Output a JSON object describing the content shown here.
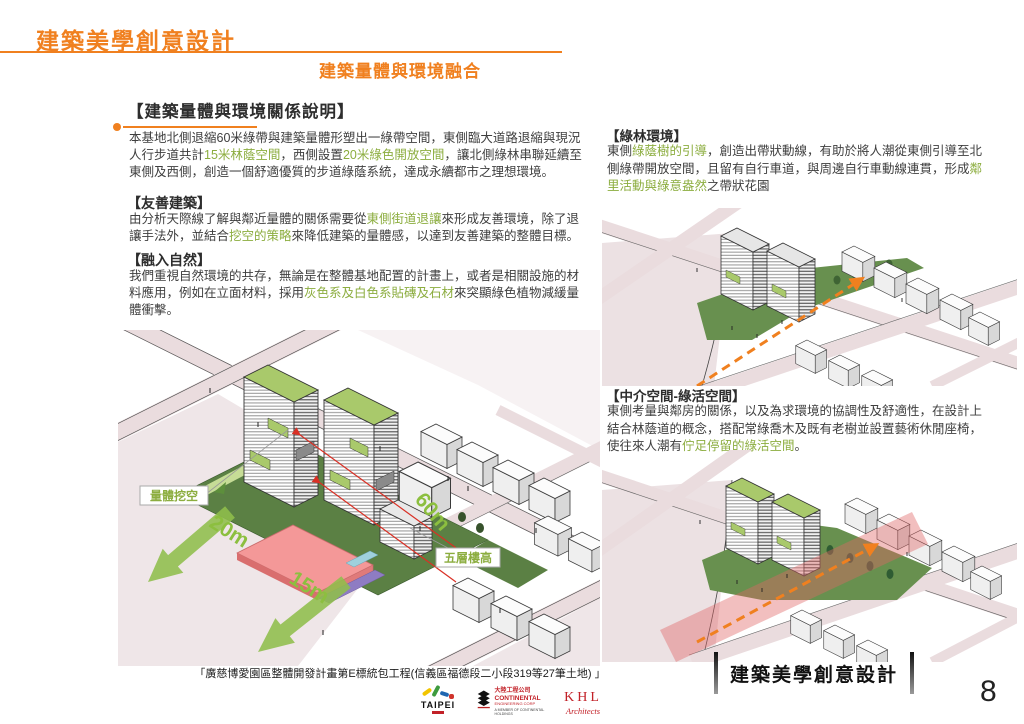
{
  "colors": {
    "accent_orange": "#f0801f",
    "highlight_green": "#8cad3f",
    "lawn_green": "#5b8044",
    "roof_green": "#a9c96b",
    "arrow_green": "#8fbe4b",
    "plaza_red": "#f49898",
    "street_pink": "#eadcde",
    "logo_red": "#c22128"
  },
  "header": {
    "title": "建築美學創意設計",
    "subtitle": "建築量體與環境融合"
  },
  "left_column": {
    "main_heading": "【建築量體與環境關係說明】",
    "intro_segments": [
      {
        "t": "本基地北側退縮60米綠帶與建築量體形塑出一綠帶空間，東側臨大道路退縮與現況人行步道共計"
      },
      {
        "t": "15米林蔭空間",
        "g": true
      },
      {
        "t": "，西側設置"
      },
      {
        "t": "20米綠色開放空間",
        "g": true
      },
      {
        "t": "，讓北側綠林串聯延續至東側及西側，創造一個舒適優質的步道綠蔭系統，達成永續都市之理想環境。"
      }
    ],
    "friendly_heading": "【友善建築】",
    "friendly_segments": [
      {
        "t": "由分析天際線了解與鄰近量體的關係需要從"
      },
      {
        "t": "東側街道退讓",
        "g": true
      },
      {
        "t": "來形成友善環境，除了退讓手法外，並結合"
      },
      {
        "t": "挖空的策略",
        "g": true
      },
      {
        "t": "來降低建築的量體感，以達到友善建築的整體目標。"
      }
    ],
    "nature_heading": "【融入自然】",
    "nature_segments": [
      {
        "t": "我們重視自然環境的共存，無論是在整體基地配置的計畫上，或者是相關設施的材料應用，例如在立面材料，採用"
      },
      {
        "t": "灰色系及白色系貼磚及石材",
        "g": true
      },
      {
        "t": "來突顯綠色植物減緩量體衝擊。"
      }
    ]
  },
  "right_column": {
    "green_env_heading": "【綠林環境】",
    "green_env_segments": [
      {
        "t": "東側"
      },
      {
        "t": "綠蔭樹的引導",
        "g": true
      },
      {
        "t": "，創造出帶狀動線，有助於將人潮從東側引導至北側綠帶開放空間，且留有自行車道，與周邊自行車動線連貫，形成"
      },
      {
        "t": "鄰里活動與綠意盎然",
        "g": true
      },
      {
        "t": "之帶狀花園"
      }
    ],
    "mid_space_heading": "【中介空間-綠活空間】",
    "mid_space_segments": [
      {
        "t": "東側考量與鄰房的關係，以及為求環境的協調性及舒適性，在設計上結合林蔭道的概念，搭配常綠喬木及既有老樹並設置藝術休閒座椅，使往來人潮有"
      },
      {
        "t": "佇足停留的綠活空間",
        "g": true
      },
      {
        "t": "。"
      }
    ]
  },
  "main_illustration": {
    "label_cutout": "量體挖空",
    "label_20m": "20m",
    "label_15m": "15m",
    "label_60m": "60m",
    "label_five_floors": "五層樓高"
  },
  "footer": {
    "project_title": "「廣慈博愛園區整體開發計畫第E標統包工程(信義區福德段二小段319等27筆土地) 」",
    "slide_title": "建築美學創意設計",
    "page_number": "8",
    "logos": {
      "taipei": "TAIPEI",
      "continental_cn": "大陸工程公司",
      "continental_en": "CONTINENTAL",
      "continental_sub": "ENGINEERING CORP",
      "continental_member": "A MEMBER OF CONTINENTAL HOLDINGS",
      "khl": "KHL",
      "khl_sub": "Architects"
    }
  }
}
